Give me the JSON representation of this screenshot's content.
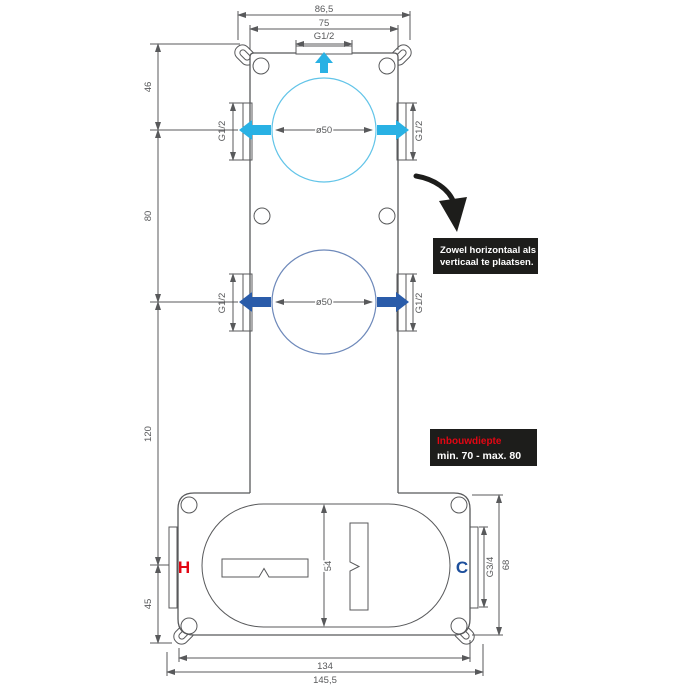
{
  "colors": {
    "line": "#58595b",
    "cyan": "#29b1e4",
    "cyan_light": "#62c4e8",
    "blue": "#2a5caa",
    "blue_light": "#6e89ba",
    "red": "#e30613",
    "cold": "#1d4f9c",
    "box_bg": "#1d1d1b"
  },
  "dims": {
    "top_outer": "86,5",
    "top_inner": "75",
    "top_port": "G1/2",
    "left_top": "46",
    "left_mid": "80",
    "left_lower": "120",
    "left_bottom": "45",
    "dia1": "ø50",
    "dia2": "ø50",
    "g12_left1": "G1/2",
    "g12_right1": "G1/2",
    "g12_left2": "G1/2",
    "g12_right2": "G1/2",
    "valve_height": "54",
    "outlet_thread": "G3/4",
    "lower_height": "68",
    "bottom_inner": "134",
    "bottom_outer": "145,5"
  },
  "labels": {
    "hot": "H",
    "cold": "C"
  },
  "callouts": {
    "placement_line1": "Zowel horizontaal als",
    "placement_line2": "verticaal te plaatsen.",
    "depth_title": "Inbouwdiepte",
    "depth_range": "min. 70 - max. 80"
  }
}
